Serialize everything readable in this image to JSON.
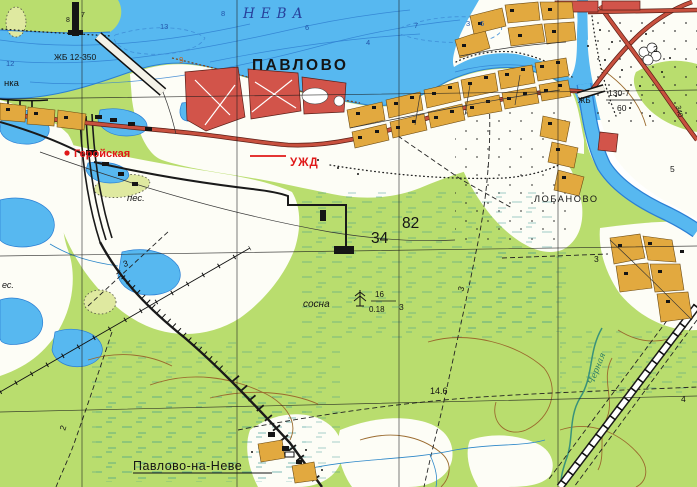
{
  "map": {
    "colors": {
      "ink": "#141414",
      "water": "#57b8f0",
      "waterEdge": "#2b7fd4",
      "forest": "#b9dd6e",
      "roadFill": "#c8503e",
      "redBlock": "#d2544a",
      "orangeBlock": "#e2a93f",
      "overprint": "#e01818",
      "waterLabel": "#27409b",
      "streamLabel": "#2e7d64",
      "contour": "#9a6a2e",
      "shoreNum": "#c06a28",
      "depthNum": "#2255aa"
    },
    "labels": [
      {
        "id": "neva",
        "text": "НЕВА",
        "x": 243,
        "y": 18,
        "size": 13.5,
        "color": "waterLabel",
        "italic": true,
        "serif": true,
        "ls": 6
      },
      {
        "id": "pavlovo",
        "text": "ПАВЛОВО",
        "x": 252,
        "y": 70,
        "size": 15.5,
        "bold": true,
        "ls": 2.5
      },
      {
        "id": "zhb-12-350",
        "text": "ЖБ 12-350",
        "x": 54,
        "y": 60,
        "size": 8.5
      },
      {
        "id": "nka",
        "text": "нка",
        "x": 4,
        "y": 86,
        "size": 9.5
      },
      {
        "id": "geroyskaya",
        "text": "Геройская",
        "x": 74,
        "y": 157,
        "size": 11,
        "color": "overprint",
        "bold": true
      },
      {
        "id": "uzhd",
        "text": "УЖД",
        "x": 290,
        "y": 166,
        "size": 11.5,
        "color": "overprint",
        "bold": true,
        "ls": 1
      },
      {
        "id": "pes",
        "text": "пес.",
        "x": 127,
        "y": 201,
        "size": 9.5,
        "italic": true
      },
      {
        "id": "es",
        "text": "ес.",
        "x": 2,
        "y": 288,
        "size": 9,
        "italic": true
      },
      {
        "id": "lobanovo",
        "text": "ЛОБАНОВО",
        "x": 534,
        "y": 202,
        "size": 9.2,
        "ls": 1.6
      },
      {
        "id": "kv-34",
        "text": "34",
        "x": 371,
        "y": 243,
        "size": 15.5
      },
      {
        "id": "kv-82",
        "text": "82",
        "x": 402,
        "y": 228,
        "size": 15.5
      },
      {
        "id": "sosna",
        "text": "сосна",
        "x": 303,
        "y": 307,
        "size": 10,
        "italic": true
      },
      {
        "id": "sosna-height",
        "text": "16",
        "x": 375,
        "y": 297,
        "size": 8
      },
      {
        "id": "sosna-diam",
        "text": "0.18",
        "x": 369,
        "y": 312,
        "size": 8
      },
      {
        "id": "sosna-step",
        "text": "3",
        "x": 399,
        "y": 310,
        "size": 8.5
      },
      {
        "id": "elev-14-6",
        "text": "14.6",
        "x": 430,
        "y": 394,
        "size": 9
      },
      {
        "id": "bridge-130-7",
        "text": "130-7",
        "x": 608,
        "y": 96,
        "size": 8.5
      },
      {
        "id": "bridge-60",
        "text": "60",
        "x": 617,
        "y": 111,
        "size": 8.5
      },
      {
        "id": "zhb-2",
        "text": "ЖБ",
        "x": 578,
        "y": 103,
        "size": 8
      },
      {
        "id": "pavlovo-na-neve",
        "text": "Павлово-на-Неве",
        "x": 133,
        "y": 470,
        "size": 12.5,
        "ls": 0.5
      },
      {
        "id": "chernaya",
        "text": "Черная",
        "x": 593,
        "y": 385,
        "size": 8.5,
        "color": "streamLabel",
        "italic": true,
        "serif": true,
        "rot": -68
      },
      {
        "id": "depth-12",
        "text": "12",
        "x": 6,
        "y": 66,
        "size": 7.5,
        "color": "depthNum"
      },
      {
        "id": "depth-13",
        "text": "13",
        "x": 160,
        "y": 29,
        "size": 7.5,
        "color": "depthNum"
      },
      {
        "id": "depth-8",
        "text": "8",
        "x": 221,
        "y": 16,
        "size": 7.5,
        "color": "depthNum"
      },
      {
        "id": "depth-6a",
        "text": "6",
        "x": 305,
        "y": 30,
        "size": 7.5,
        "color": "depthNum"
      },
      {
        "id": "depth-7",
        "text": "7",
        "x": 414,
        "y": 28,
        "size": 7.5,
        "color": "depthNum"
      },
      {
        "id": "depth-4",
        "text": "4",
        "x": 366,
        "y": 45,
        "size": 7.5,
        "color": "depthNum"
      },
      {
        "id": "depth-3",
        "text": "3",
        "x": 466,
        "y": 26,
        "size": 7.5,
        "color": "depthNum"
      },
      {
        "id": "depth-6b",
        "text": "6",
        "x": 480,
        "y": 26,
        "size": 7.5,
        "color": "depthNum"
      },
      {
        "id": "shore-8",
        "text": "8",
        "x": 66,
        "y": 22,
        "size": 7
      },
      {
        "id": "shore-7",
        "text": "7",
        "x": 81,
        "y": 17,
        "size": 7
      },
      {
        "id": "shore-9",
        "text": "9",
        "x": 179,
        "y": 63,
        "size": 8,
        "color": "shoreNum"
      },
      {
        "id": "num-2-field",
        "text": "2",
        "x": 653,
        "y": 52,
        "size": 8.5
      },
      {
        "id": "num-5",
        "text": "5",
        "x": 670,
        "y": 172,
        "size": 8.5
      },
      {
        "id": "num-4",
        "text": "4",
        "x": 681,
        "y": 402,
        "size": 8.5
      },
      {
        "id": "trail-3a",
        "text": "3",
        "x": 124,
        "y": 267,
        "size": 8.5,
        "rot": -15
      },
      {
        "id": "trail-3b",
        "text": "3",
        "x": 463,
        "y": 292,
        "size": 8.5,
        "rot": -70
      },
      {
        "id": "trail-3c",
        "text": "3",
        "x": 594,
        "y": 262,
        "size": 8.5
      },
      {
        "id": "trail-2",
        "text": "2",
        "x": 65,
        "y": 431,
        "size": 8.5,
        "rot": -72
      },
      {
        "id": "road-340",
        "text": "340",
        "x": 676,
        "y": 106,
        "size": 7,
        "rot": 78
      }
    ]
  }
}
